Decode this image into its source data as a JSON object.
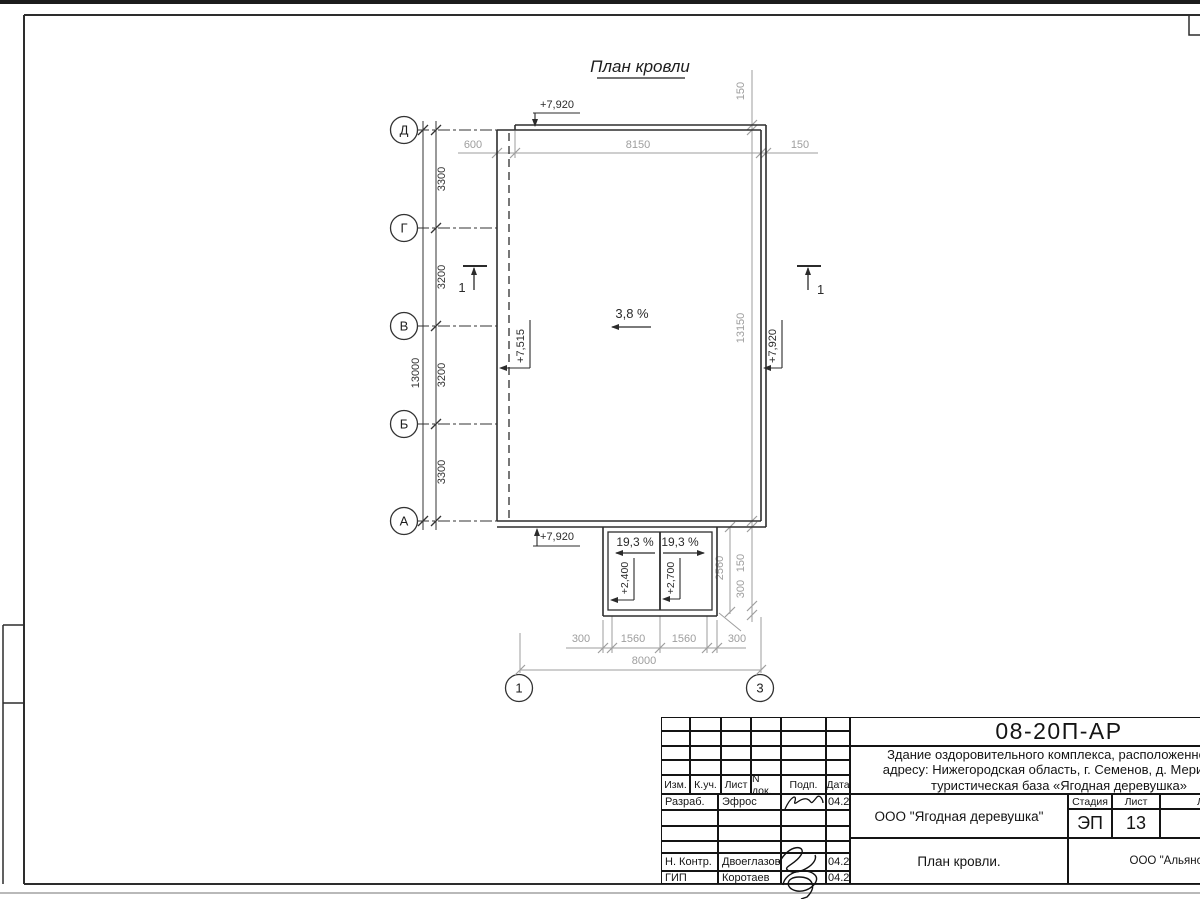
{
  "drawing": {
    "title": "План кровли",
    "slopes": {
      "main": "3,8 %",
      "porch_left": "19,3 %",
      "porch_right": "19,3 %"
    },
    "elevations": {
      "roof_top": "+7,920",
      "roof_bottom": "+7,920",
      "roof_inner": "+7,515",
      "roof_right": "+7,920",
      "porch_left": "+2,400",
      "porch_right": "+2,700"
    },
    "row_axes": [
      "Д",
      "Г",
      "В",
      "Б",
      "А"
    ],
    "col_axes": [
      "1",
      "3"
    ],
    "section_label": "1",
    "dims": {
      "top": {
        "d600": "600",
        "d8150": "8150",
        "d150": "150",
        "d150_vert": "150"
      },
      "left": {
        "v0": "3300",
        "v1": "3200",
        "v2": "3200",
        "v3": "3300",
        "total": "13000"
      },
      "right": {
        "d13150": "13150",
        "d150": "150",
        "d300": "300",
        "d2560": "2560"
      },
      "bottom": {
        "b0": "300",
        "b1": "1560",
        "b2": "1560",
        "b3": "300",
        "total": "8000"
      }
    }
  },
  "title_block": {
    "doc_number": "08-20П-АР",
    "description_line1": "Здание оздоровительного комплекса, расположенное по",
    "description_line2": "адресу: Нижегородская область, г. Семенов, д. Мериново,",
    "description_line3": "туристическая база «Ягодная деревушка»",
    "revision_header": {
      "izm": "Изм.",
      "kuch": "К.уч.",
      "list": "Лист",
      "ndok": "N док.",
      "podp": "Подп.",
      "data": "Дата"
    },
    "rows": [
      {
        "role": "Разраб.",
        "name": "Эфрос",
        "date": "04.20"
      },
      {
        "role": "Н. Контр.",
        "name": "Двоеглазов",
        "date": "04.20"
      },
      {
        "role": "ГИП",
        "name": "Коротаев",
        "date": "04.20"
      }
    ],
    "company": "ООО \"Ягодная деревушка\"",
    "stage_label": "Стадия",
    "sheet_label": "Лист",
    "sheets_label": "Листов",
    "stage_value": "ЭП",
    "sheet_value": "13",
    "drawing_name": "План кровли.",
    "org": "ООО \"Альянс\""
  }
}
